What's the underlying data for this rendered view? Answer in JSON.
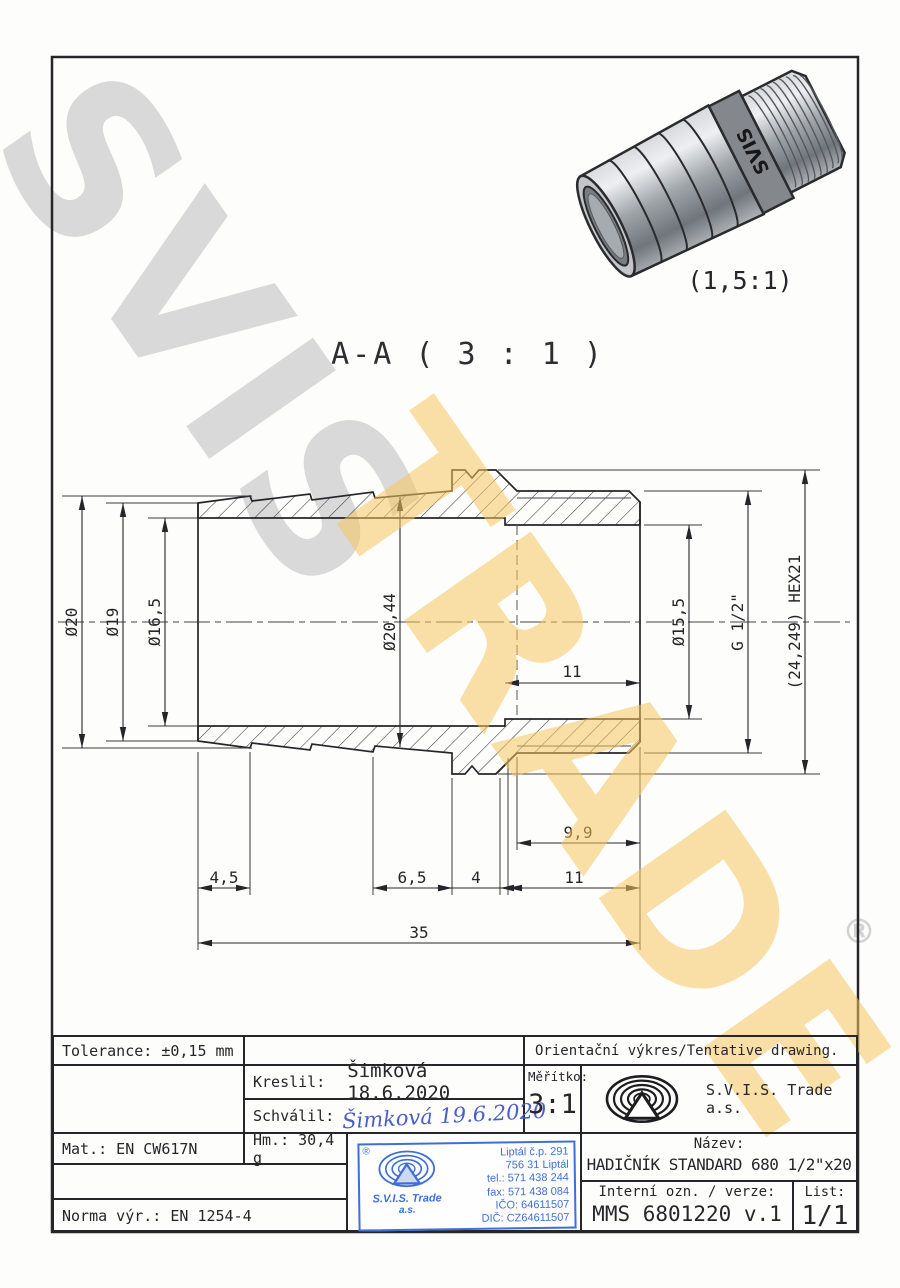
{
  "watermarks": {
    "primary": "SVIS",
    "secondary": "TRADE",
    "registered": "®"
  },
  "photo": {
    "caption": "(1,5:1)",
    "brand": "SVIS"
  },
  "section": {
    "title": "A-A ( 3 : 1 )"
  },
  "dimensions": {
    "d20": "Ø20",
    "d19": "Ø19",
    "d165": "Ø16,5",
    "d2044": "Ø20,44",
    "d155": "Ø15,5",
    "g12": "G 1/2\"",
    "hex": "(24,249) HEX21",
    "bore11": "11",
    "t99": "9,9",
    "l45": "4,5",
    "l65": "6,5",
    "l4": "4",
    "l11": "11",
    "l35": "35"
  },
  "title_block": {
    "tolerance": "Tolerance: ±0,15 mm",
    "orientacni": "Orientační výkres/Tentative drawing.",
    "kreslil_label": "Kreslil:",
    "kreslil_value": "Šimková 18.6.2020",
    "schvalil_label": "Schválil:",
    "schvalil_value": "Šimková 19.6.2020",
    "meritko_label": "Měřítko:",
    "meritko_value": "3:1",
    "company": "S.V.I.S. Trade a.s.",
    "mat": "Mat.: EN CW617N",
    "hm": "Hm.: 30,4 g",
    "norma": "Norma výr.: EN 1254-4",
    "nazev_label": "Název:",
    "nazev_value": "HADIČNÍK STANDARD 680 1/2\"x20",
    "interni_label": "Interní ozn. / verze:",
    "interni_value": "MMS 6801220 v.1",
    "list_label": "List:",
    "list_value": "1/1"
  },
  "stamp": {
    "reg": "®",
    "company": "S.V.I.S. Trade",
    "suffix": "a.s.",
    "line1": "Liptál č.p. 291",
    "line2": "756 31 Liptál",
    "line3": "tel.: 571 438 244",
    "line4": "fax: 571 438 084",
    "line5": "IČO: 64611507",
    "line6": "DIČ: CZ64611507"
  }
}
